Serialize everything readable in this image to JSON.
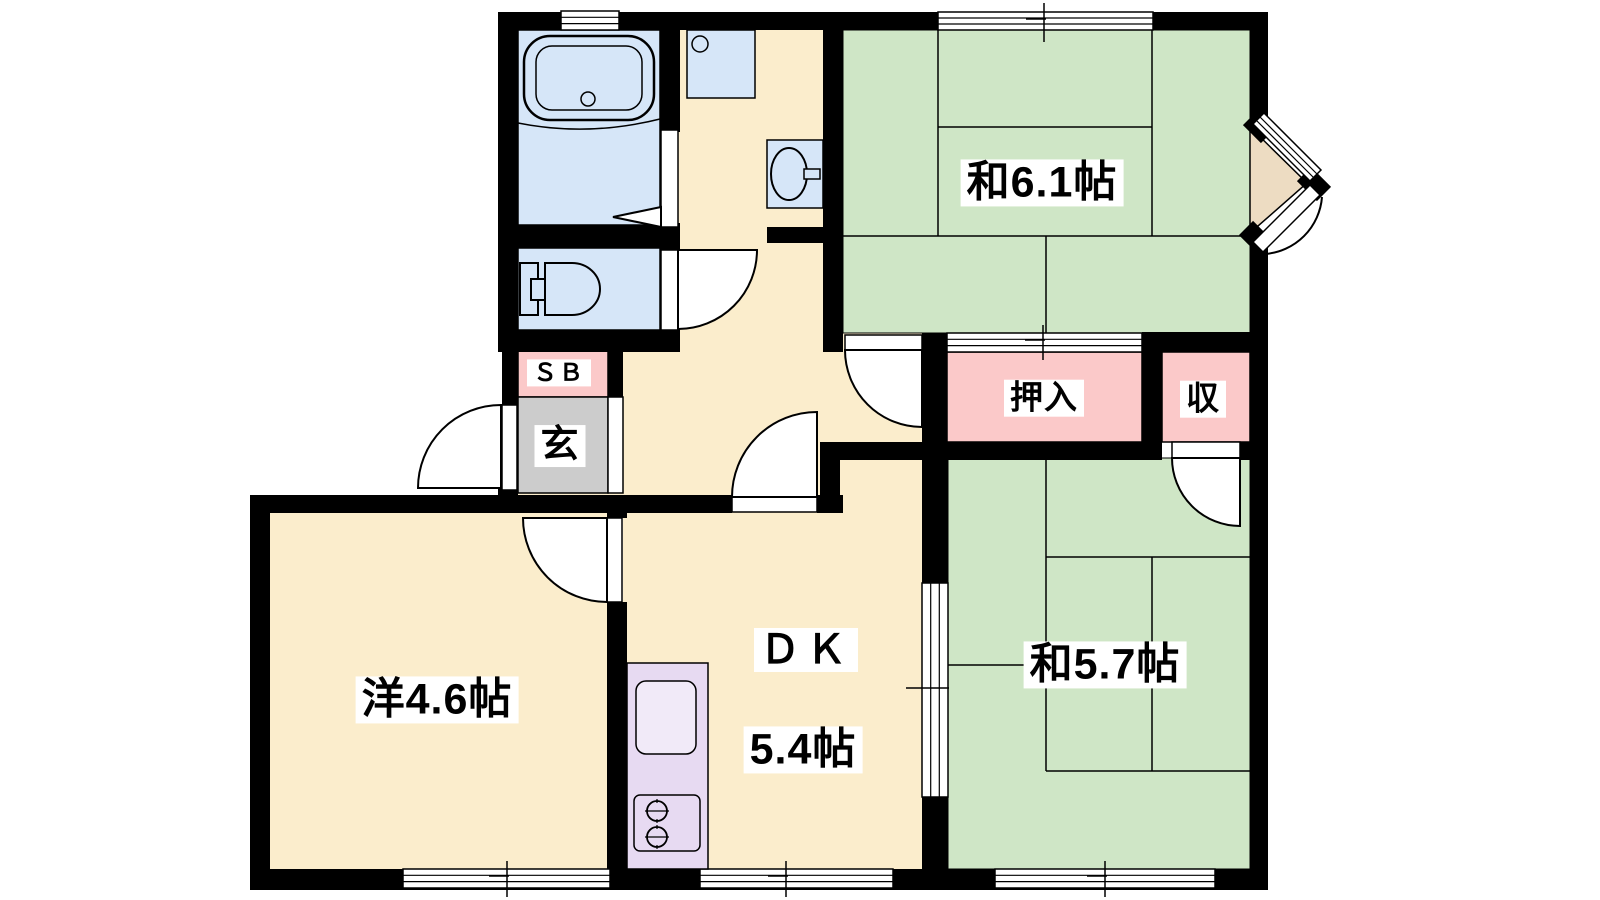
{
  "plan": {
    "type": "apartment-floor-plan",
    "layout_name": "2DK",
    "rooms": [
      {
        "id": "washitsu61",
        "label": "和6.1帖",
        "kind": "japanese-tatami-room",
        "size_jo": 6.1
      },
      {
        "id": "washitsu57",
        "label": "和5.7帖",
        "kind": "japanese-tatami-room",
        "size_jo": 5.7
      },
      {
        "id": "western",
        "label": "洋4.6帖",
        "kind": "western-room",
        "size_jo": 4.6
      },
      {
        "id": "dk",
        "label": "ＤＫ",
        "size_label": "5.4帖",
        "kind": "dining-kitchen",
        "size_jo": 5.4
      },
      {
        "id": "oshiire",
        "label": "押入",
        "kind": "futon-closet"
      },
      {
        "id": "shu",
        "label": "収",
        "kind": "storage"
      },
      {
        "id": "sb",
        "label": "ＳＢ",
        "kind": "shoe-box"
      },
      {
        "id": "genkan",
        "label": "玄",
        "kind": "entrance"
      }
    ],
    "fixtures": [
      "bathtub",
      "toilet",
      "washbasin",
      "washing-machine-pan",
      "kitchen-sink",
      "gas-stove-2-burner"
    ],
    "palette": {
      "wall": "#000000",
      "tatami_green": "#cfe6c6",
      "floor_cream": "#fbedcc",
      "water_blue": "#d6e6f8",
      "closet_pink": "#fbc9c9",
      "genkan_gray": "#cccccc",
      "kitchen_purple": "#e7daf2",
      "corner_tan": "#eddcc2",
      "sink_light": "#f1eaf8"
    }
  },
  "labels": {
    "washitsu61": "和6.1帖",
    "washitsu57": "和5.7帖",
    "western": "洋4.6帖",
    "dk": "ＤＫ",
    "dk_size": "5.4帖",
    "oshiire": "押入",
    "shu": "収",
    "sb": "ＳＢ",
    "genkan": "玄"
  }
}
